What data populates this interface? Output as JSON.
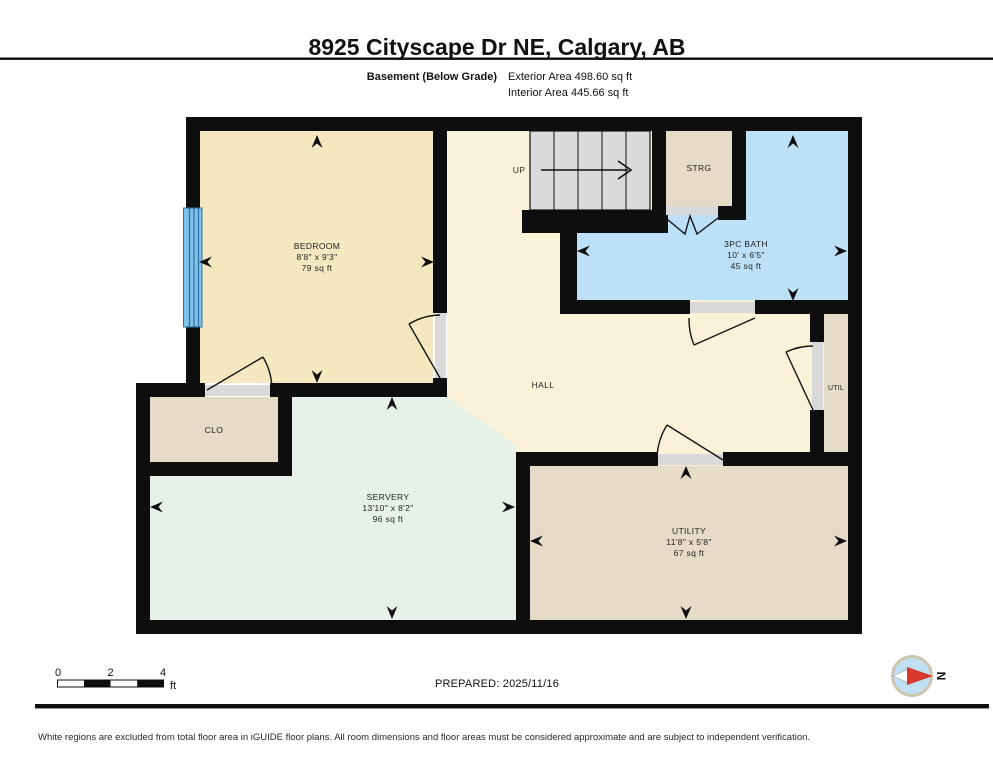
{
  "header": {
    "title": "8925 Cityscape Dr NE, Calgary, AB",
    "floor_label": "Basement (Below Grade)",
    "exterior_area": "Exterior Area 498.60 sq ft",
    "interior_area": "Interior Area 445.66 sq ft"
  },
  "plan": {
    "stairs": {
      "label": "UP"
    },
    "rooms": {
      "bedroom": {
        "name": "BEDROOM",
        "dims": "8'8\" x 9'3\"",
        "area": "79 sq ft"
      },
      "strg": {
        "name": "STRG"
      },
      "bath": {
        "name": "3PC BATH",
        "dims": "10' x 6'5\"",
        "area": "45 sq ft"
      },
      "hall": {
        "name": "HALL"
      },
      "util": {
        "name": "UTIL"
      },
      "clo": {
        "name": "CLO"
      },
      "servery": {
        "name": "SERVERY",
        "dims": "13'10\" x 8'2\"",
        "area": "96 sq ft"
      },
      "utility": {
        "name": "UTILITY",
        "dims": "11'8\" x 5'8\"",
        "area": "67 sq ft"
      }
    }
  },
  "footer": {
    "scale": {
      "start": "0",
      "mid": "2",
      "end": "4",
      "unit": "ft"
    },
    "prepared": "PREPARED: 2025/11/16",
    "compass_letter": "N",
    "disclaimer": "White regions are excluded from total floor area in iGUIDE floor plans. All room dimensions and floor areas must be considered approximate and are subject to independent verification."
  },
  "colors": {
    "wall": "#0e0e0e",
    "bedroom_cream": "#F5E8C0",
    "hall_cream": "#FAF2D8",
    "tan": "#E5DBC7",
    "mint": "#E6F1E8",
    "bath_blue": "#BCE0F7",
    "stairs_gray": "#DBDBDB",
    "jamb_gray": "#D9D9D9",
    "window_blue": "#7FC3EB",
    "window_line": "#2E6E9E",
    "door": "#141414",
    "compass_fill": "#BFDFF3",
    "compass_ring": "#CFC4AD",
    "compass_red": "#D8372A"
  }
}
